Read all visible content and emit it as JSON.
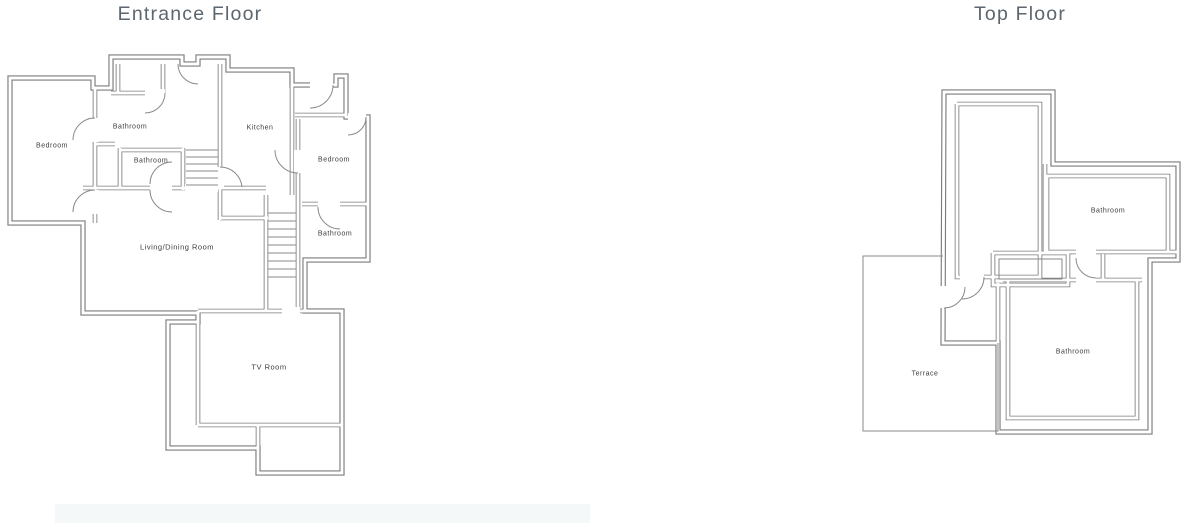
{
  "colors": {
    "background": "#ffffff",
    "wall_line": "#7c7c7c",
    "thin_line": "#8a8a8a",
    "room_label_text": "#3c3c3c",
    "title_text": "#5c666e",
    "footer_bar": "#f5f8f9"
  },
  "floors": [
    {
      "title": "Entrance Floor",
      "rooms": [
        {
          "label": "Bedroom"
        },
        {
          "label": "Bathroom"
        },
        {
          "label": "Bathroom"
        },
        {
          "label": "Kitchen"
        },
        {
          "label": "Bedroom"
        },
        {
          "label": "Bathroom"
        },
        {
          "label": "Living/Dining Room"
        },
        {
          "label": "TV Room"
        }
      ]
    },
    {
      "title": "Top Floor",
      "rooms": [
        {
          "label": "Bathroom"
        },
        {
          "label": "Bathroom"
        },
        {
          "label": "Terrace"
        }
      ]
    }
  ]
}
